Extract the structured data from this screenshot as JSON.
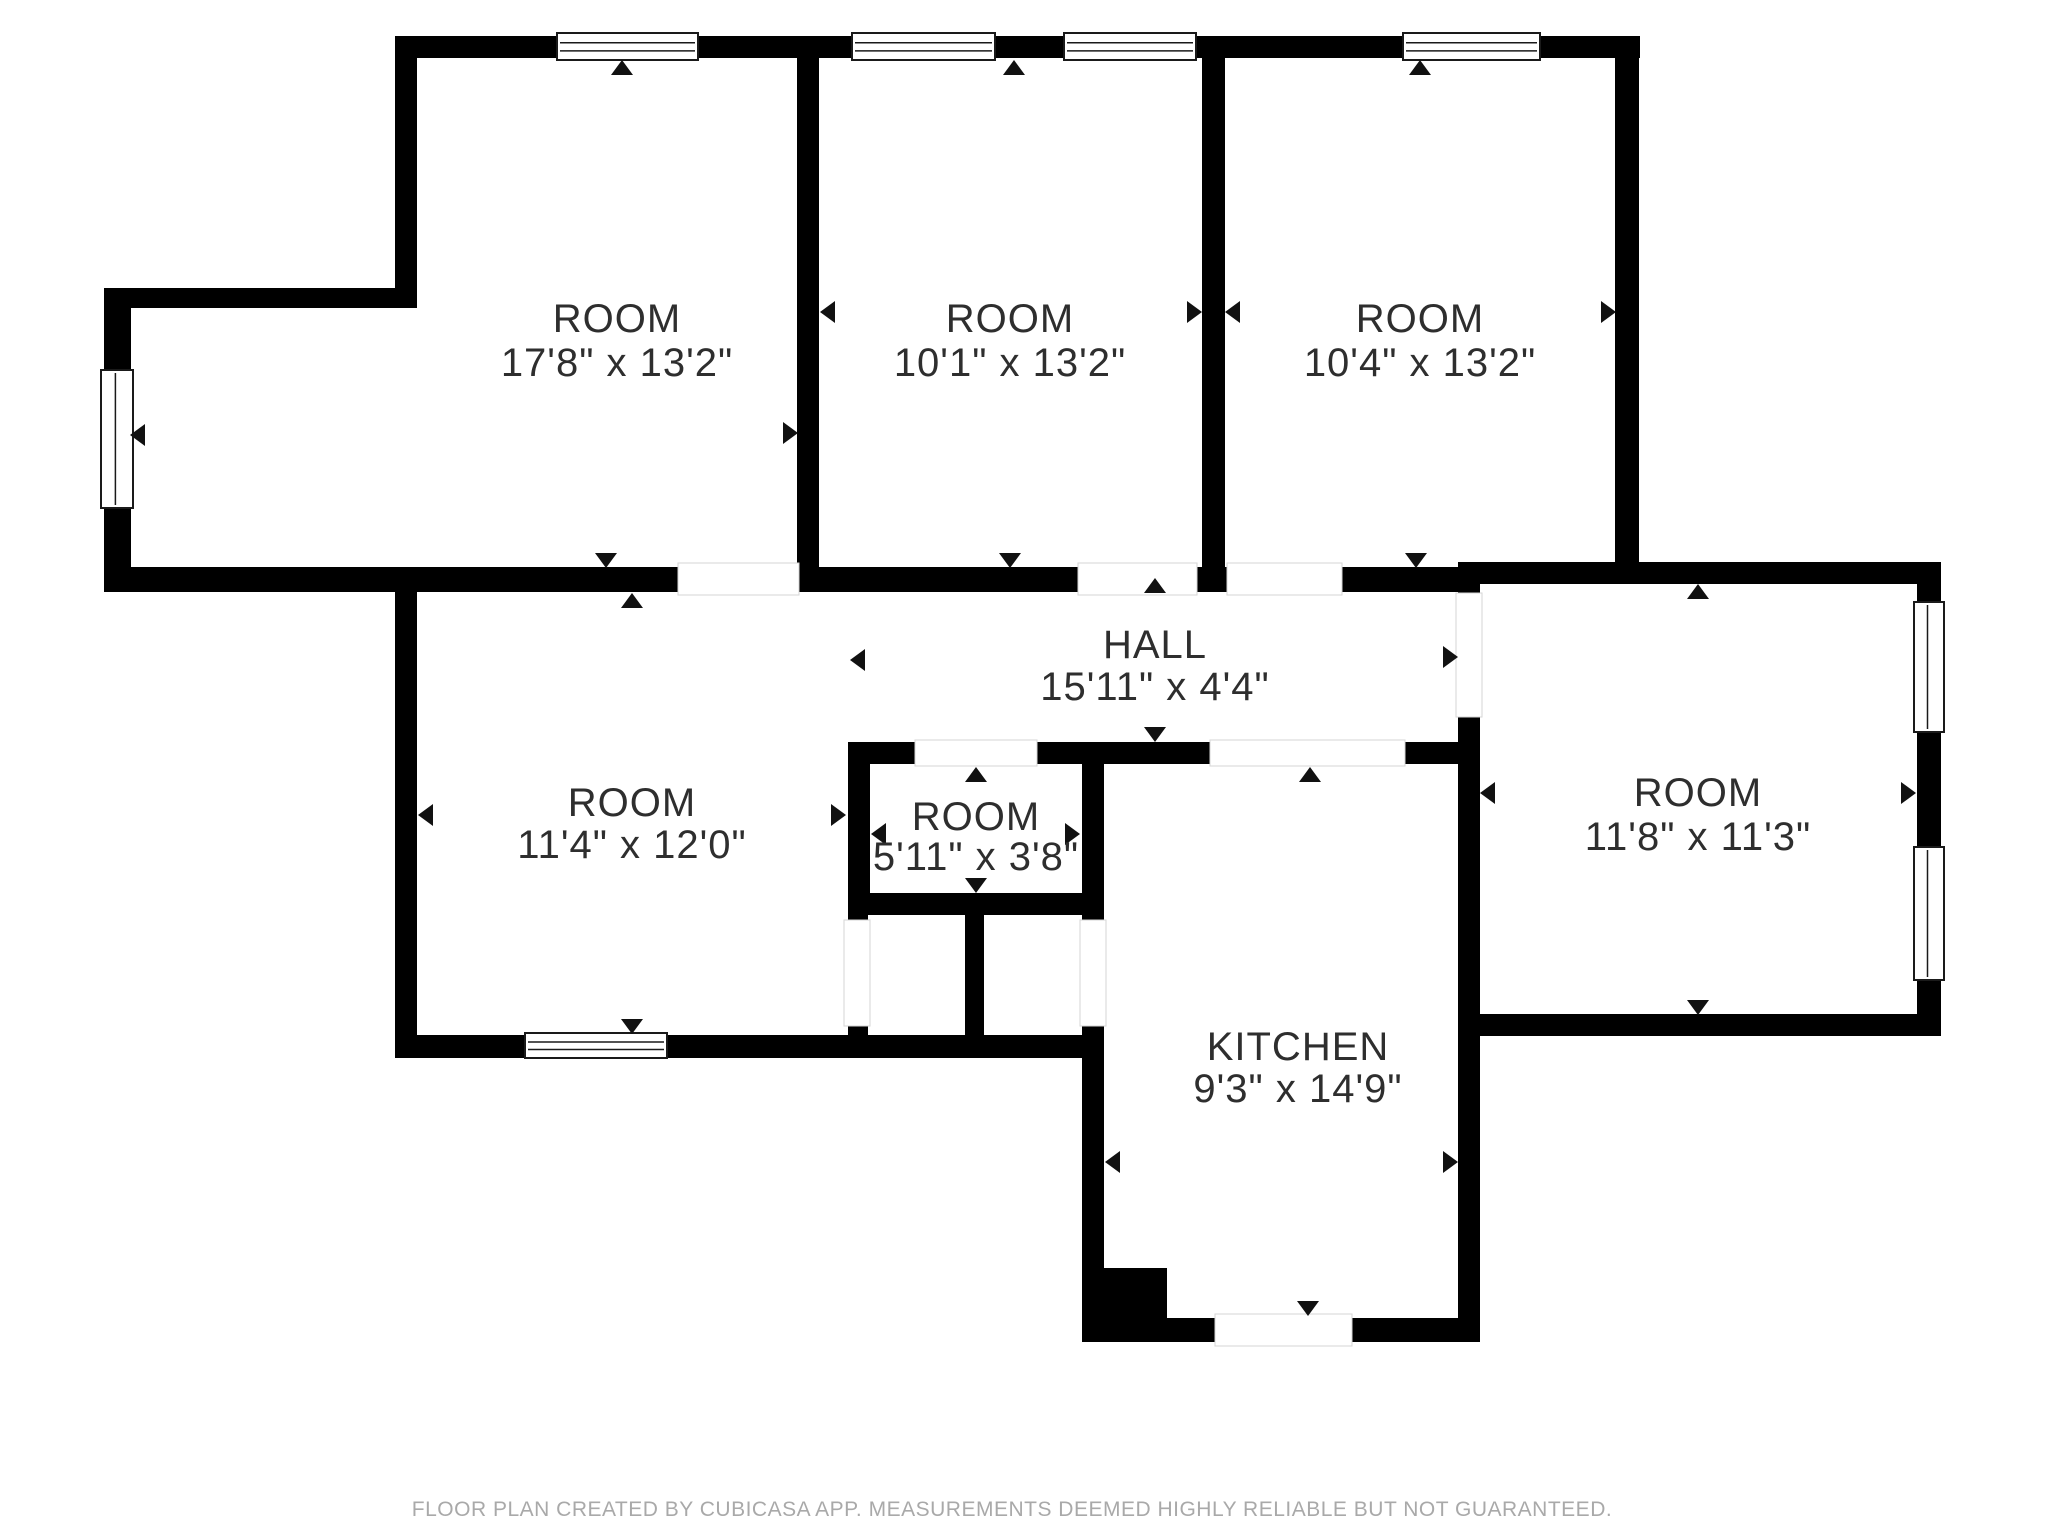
{
  "footer": {
    "text": "FLOOR PLAN CREATED BY CUBICASA APP. MEASUREMENTS DEEMED HIGHLY RELIABLE BUT NOT GUARANTEED."
  },
  "colors": {
    "background": "#ffffff",
    "wall": "#000000",
    "label": "#2e2e2e",
    "footer_text": "#a9a9a9",
    "window_frame": "#1a1a1a",
    "opening_edge": "#d5d5d5",
    "arrow": "#111111"
  },
  "rooms": [
    {
      "id": "room-top-left",
      "name": "ROOM",
      "dims": "17'8\" x 13'2\""
    },
    {
      "id": "room-top-middle",
      "name": "ROOM",
      "dims": "10'1\" x 13'2\""
    },
    {
      "id": "room-top-right",
      "name": "ROOM",
      "dims": "10'4\" x 13'2\""
    },
    {
      "id": "hall",
      "name": "HALL",
      "dims": "15'11\" x 4'4\""
    },
    {
      "id": "room-bottom-left",
      "name": "ROOM",
      "dims": "11'4\" x 12'0\""
    },
    {
      "id": "room-small",
      "name": "ROOM",
      "dims": "5'11\" x 3'8\""
    },
    {
      "id": "kitchen",
      "name": "KITCHEN",
      "dims": "9'3\" x 14'9\""
    },
    {
      "id": "room-right",
      "name": "ROOM",
      "dims": "11'8\" x 11'3\""
    }
  ],
  "floorplan": {
    "canvas": {
      "w": 2048,
      "h": 1536
    },
    "walls": [
      [
        395,
        36,
        1245,
        22
      ],
      [
        395,
        36,
        22,
        272
      ],
      [
        104,
        288,
        313,
        20
      ],
      [
        104,
        288,
        27,
        304
      ],
      [
        104,
        567,
        1376,
        25
      ],
      [
        797,
        58,
        22,
        509
      ],
      [
        1202,
        58,
        23,
        509
      ],
      [
        1615,
        58,
        24,
        526
      ],
      [
        1460,
        562,
        480,
        22
      ],
      [
        1458,
        562,
        22,
        780
      ],
      [
        1917,
        562,
        24,
        474
      ],
      [
        1458,
        1014,
        483,
        22
      ],
      [
        848,
        742,
        632,
        22
      ],
      [
        848,
        742,
        22,
        173
      ],
      [
        1082,
        742,
        22,
        600
      ],
      [
        848,
        893,
        256,
        22
      ],
      [
        965,
        915,
        19,
        125
      ],
      [
        848,
        915,
        20,
        125
      ],
      [
        395,
        1035,
        709,
        23
      ],
      [
        395,
        567,
        22,
        491
      ],
      [
        1082,
        1318,
        398,
        24
      ],
      [
        1102,
        1268,
        65,
        54
      ]
    ],
    "openings": [
      {
        "r": [
          678,
          563,
          121,
          32
        ],
        "o": "h"
      },
      {
        "r": [
          1078,
          563,
          119,
          32
        ],
        "o": "h"
      },
      {
        "r": [
          1227,
          563,
          115,
          32
        ],
        "o": "h"
      },
      {
        "r": [
          1456,
          593,
          26,
          124
        ],
        "o": "v"
      },
      {
        "r": [
          915,
          740,
          122,
          26
        ],
        "o": "h"
      },
      {
        "r": [
          1210,
          740,
          195,
          26
        ],
        "o": "h"
      },
      {
        "r": [
          844,
          920,
          26,
          106
        ],
        "o": "v"
      },
      {
        "r": [
          1080,
          920,
          26,
          106
        ],
        "o": "v"
      },
      {
        "r": [
          1215,
          1314,
          137,
          32
        ],
        "o": "h"
      }
    ],
    "windows": [
      {
        "r": [
          557,
          33,
          141,
          27
        ],
        "o": "h"
      },
      {
        "r": [
          852,
          33,
          143,
          27
        ],
        "o": "h"
      },
      {
        "r": [
          1064,
          33,
          132,
          27
        ],
        "o": "h"
      },
      {
        "r": [
          1403,
          33,
          137,
          27
        ],
        "o": "h"
      },
      {
        "r": [
          101,
          370,
          32,
          138
        ],
        "o": "v"
      },
      {
        "r": [
          1914,
          602,
          30,
          130
        ],
        "o": "v"
      },
      {
        "r": [
          1914,
          847,
          30,
          133
        ],
        "o": "v"
      },
      {
        "r": [
          525,
          1033,
          142,
          25
        ],
        "o": "h"
      }
    ],
    "arrows": [
      {
        "x": 622,
        "y": 68,
        "d": "up"
      },
      {
        "x": 606,
        "y": 560,
        "d": "down"
      },
      {
        "x": 138,
        "y": 435,
        "d": "left"
      },
      {
        "x": 790,
        "y": 433,
        "d": "right"
      },
      {
        "x": 1014,
        "y": 68,
        "d": "up"
      },
      {
        "x": 1010,
        "y": 560,
        "d": "down"
      },
      {
        "x": 828,
        "y": 312,
        "d": "left"
      },
      {
        "x": 1194,
        "y": 312,
        "d": "right"
      },
      {
        "x": 1420,
        "y": 68,
        "d": "up"
      },
      {
        "x": 1416,
        "y": 560,
        "d": "down"
      },
      {
        "x": 1233,
        "y": 312,
        "d": "left"
      },
      {
        "x": 1608,
        "y": 312,
        "d": "right"
      },
      {
        "x": 632,
        "y": 601,
        "d": "up"
      },
      {
        "x": 632,
        "y": 1026,
        "d": "down"
      },
      {
        "x": 426,
        "y": 815,
        "d": "left"
      },
      {
        "x": 838,
        "y": 815,
        "d": "right"
      },
      {
        "x": 1155,
        "y": 586,
        "d": "up"
      },
      {
        "x": 1155,
        "y": 734,
        "d": "down"
      },
      {
        "x": 858,
        "y": 660,
        "d": "left"
      },
      {
        "x": 1450,
        "y": 657,
        "d": "right"
      },
      {
        "x": 976,
        "y": 775,
        "d": "up"
      },
      {
        "x": 976,
        "y": 885,
        "d": "down"
      },
      {
        "x": 879,
        "y": 834,
        "d": "left"
      },
      {
        "x": 1072,
        "y": 834,
        "d": "right"
      },
      {
        "x": 1310,
        "y": 775,
        "d": "up"
      },
      {
        "x": 1308,
        "y": 1308,
        "d": "down"
      },
      {
        "x": 1113,
        "y": 1162,
        "d": "left"
      },
      {
        "x": 1450,
        "y": 1162,
        "d": "right"
      },
      {
        "x": 1698,
        "y": 592,
        "d": "up"
      },
      {
        "x": 1698,
        "y": 1007,
        "d": "down"
      },
      {
        "x": 1488,
        "y": 793,
        "d": "left"
      },
      {
        "x": 1908,
        "y": 793,
        "d": "right"
      }
    ]
  }
}
